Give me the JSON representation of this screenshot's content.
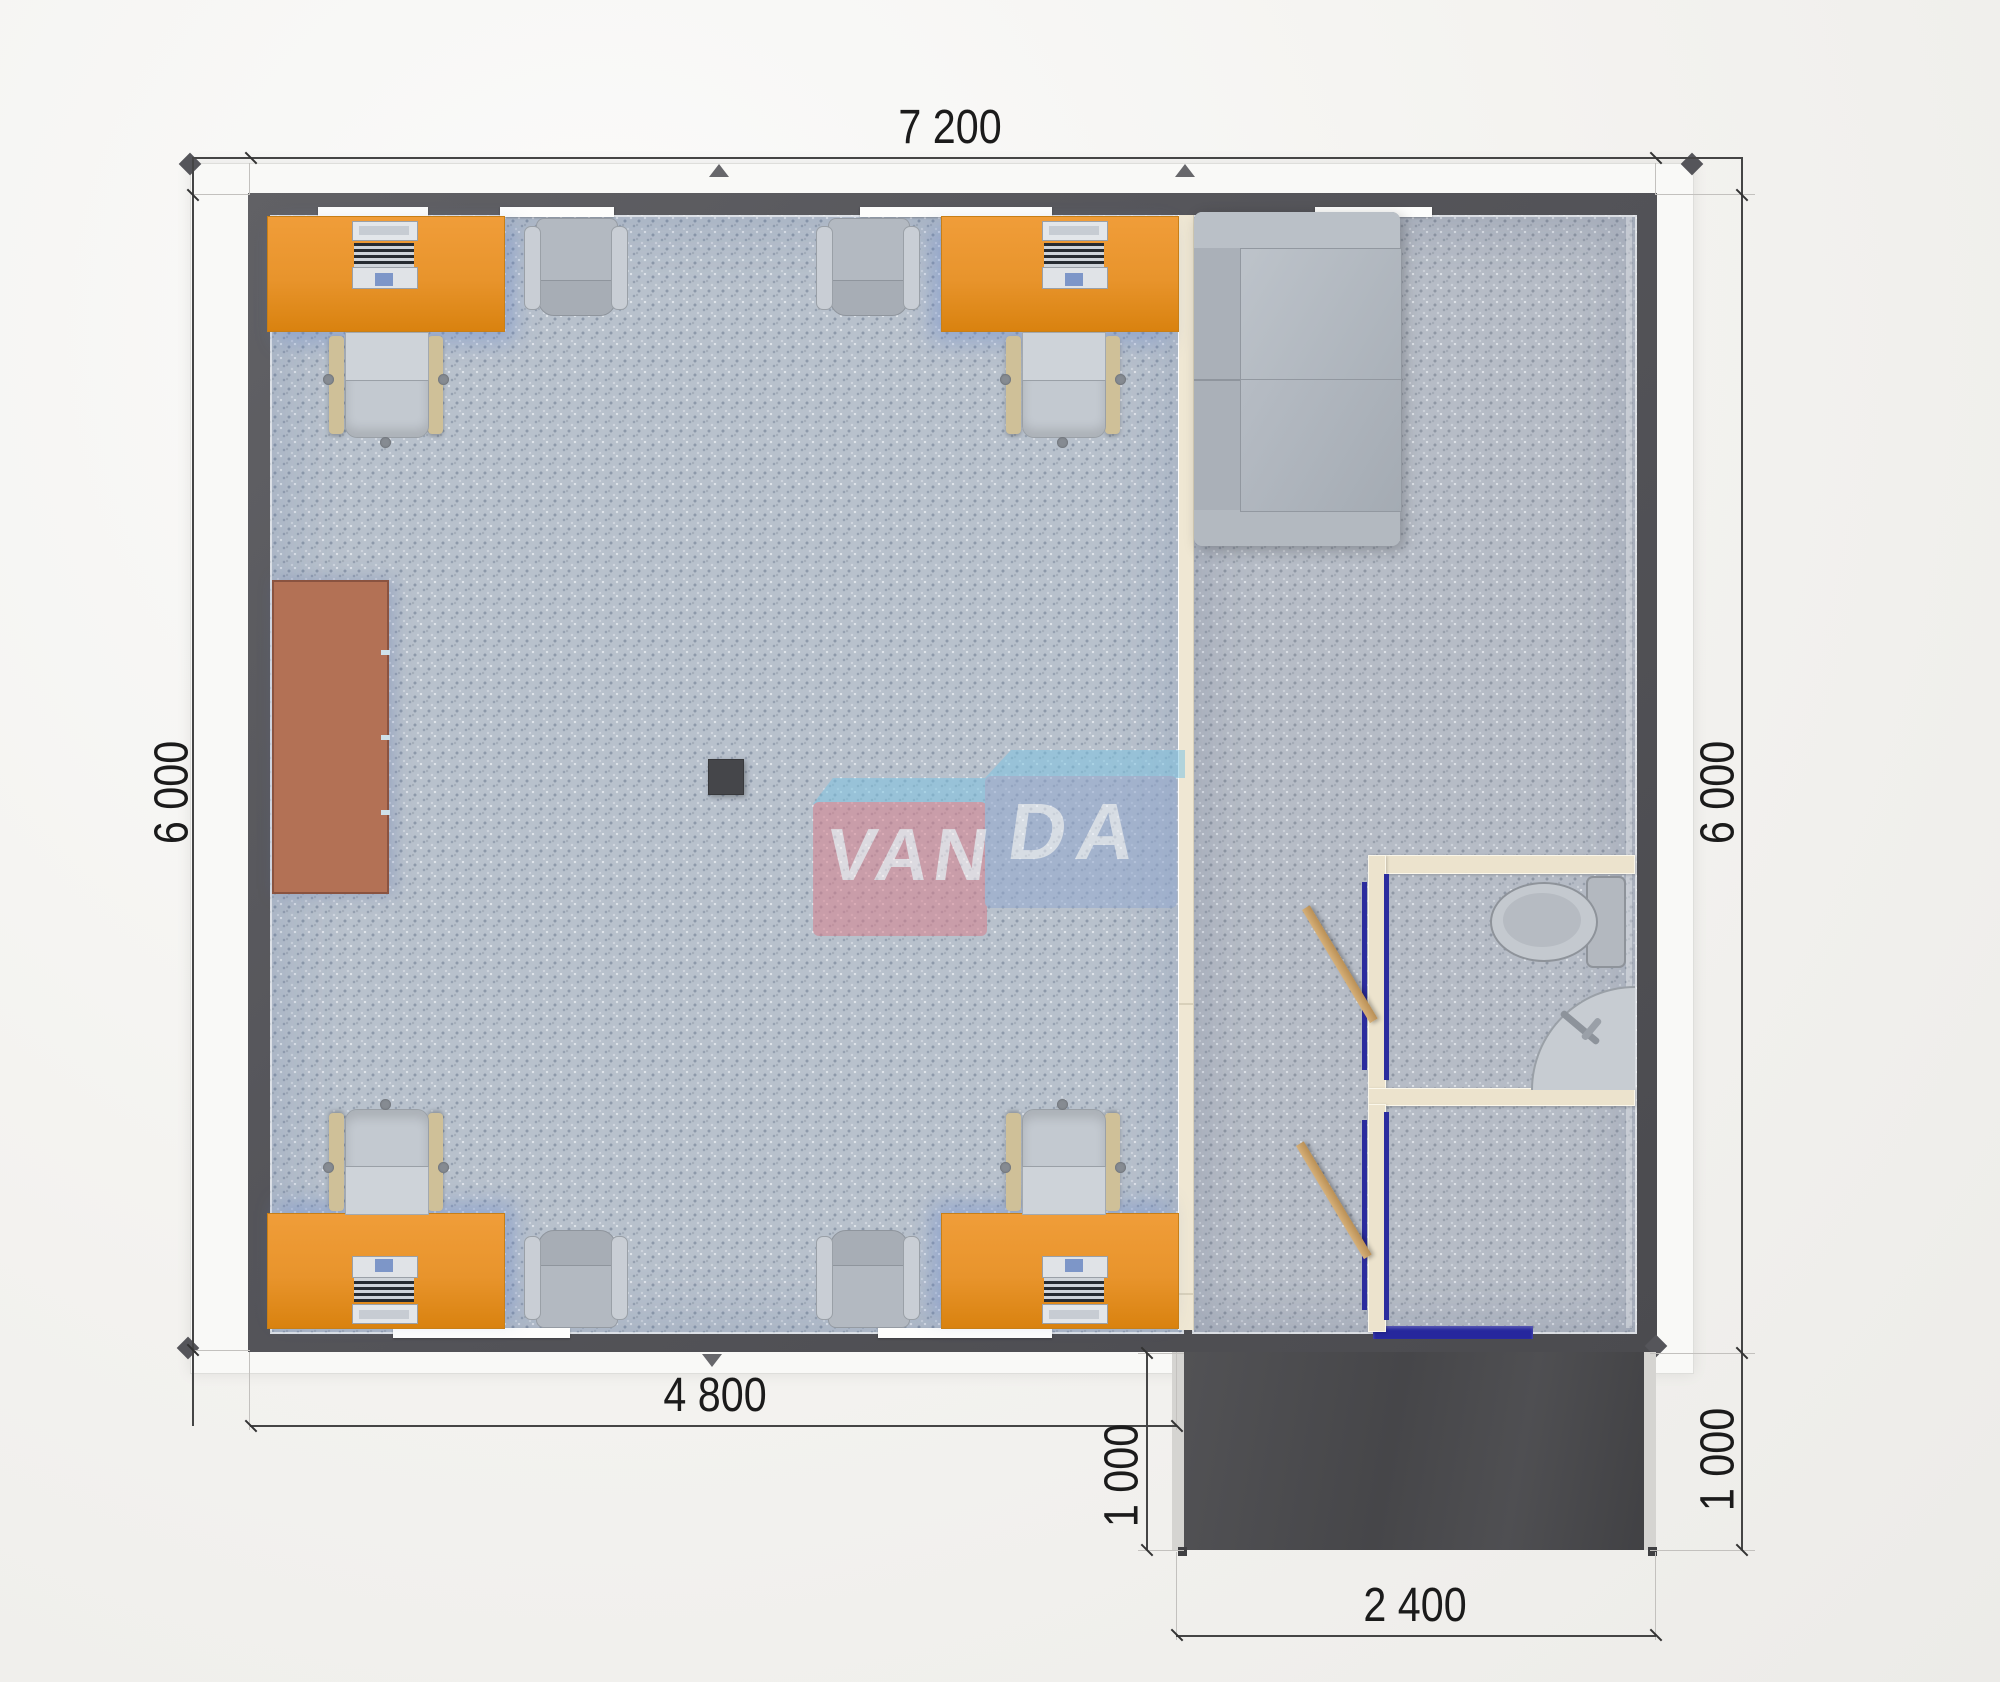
{
  "plan": {
    "watermark": {
      "left_text": "VAN",
      "right_text": "DA",
      "full_text": "VANDA"
    },
    "dimensions": {
      "top_width": "7 200",
      "left_height": "6 000",
      "right_height": "6 000",
      "bottom_left_width": "4 800",
      "porch_height_left": "1 000",
      "porch_height_right": "1 000",
      "porch_width": "2 400"
    },
    "colors": {
      "wall": "#55555a",
      "roof_trim": "#f9f9f7",
      "desk_orange": "#e8942c",
      "table_brown": "#b37155",
      "partition_beige": "#efe7d3",
      "door_leaf_tan": "#c9a26b",
      "door_frame_navy": "#2b2c9e",
      "entrance_door_navy": "#26279d",
      "porch_dark": "#4a4a4d",
      "carpet_left": "#b8c1cc",
      "carpet_right": "#b6bcc6",
      "logo_pink": "#d8808d",
      "logo_blue": "#93a9cf",
      "logo_light_blue": "#7fc4e2",
      "dimension_text": "#1b1b1b"
    }
  }
}
